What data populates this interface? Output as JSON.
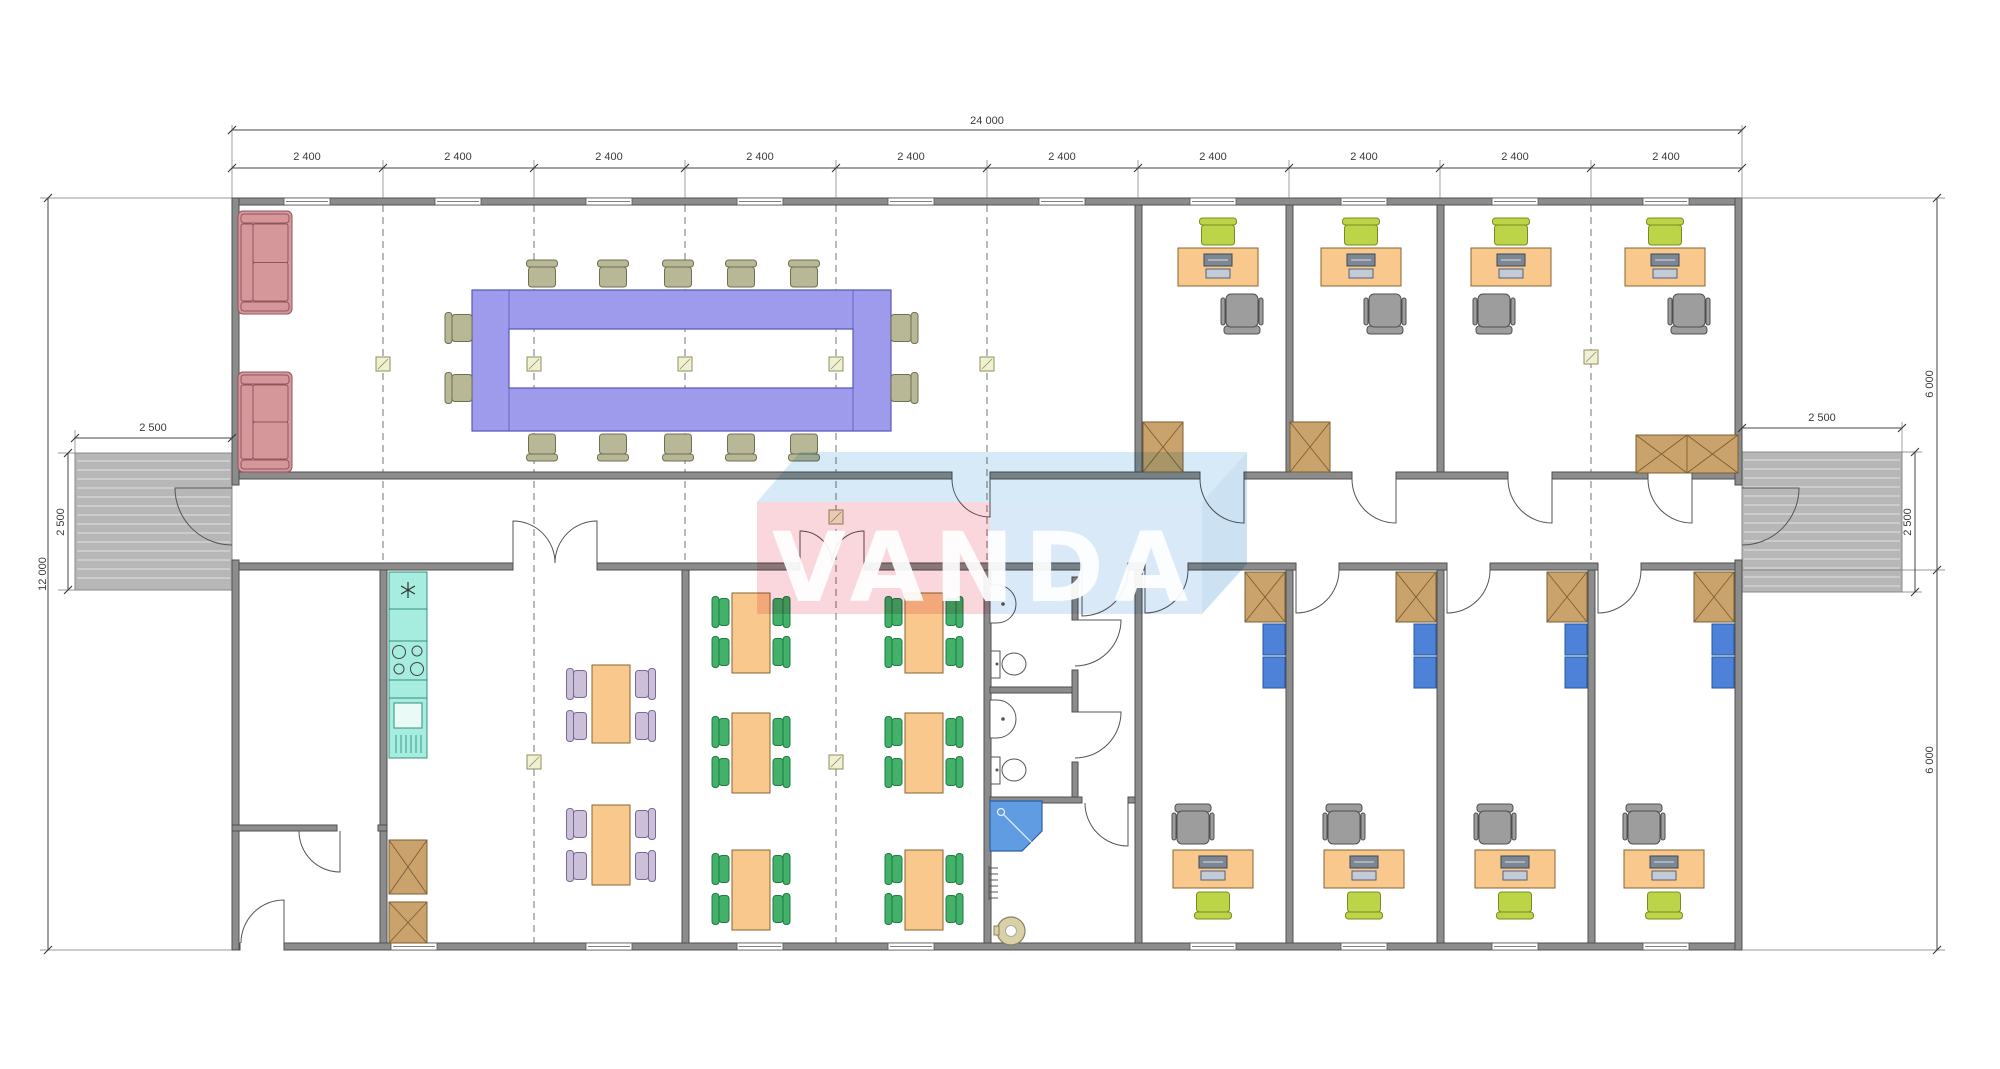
{
  "watermark": {
    "text": "VANDA"
  },
  "dims": {
    "overall": "24 000",
    "bay": "2 400",
    "height": "12 000",
    "porch": "2 500",
    "half": "6 000"
  },
  "palette": {
    "wall": "#8c8c8c",
    "wall_edge": "#4f4f4f",
    "window": "#ffffff",
    "line": "#555555",
    "sofa": "#d6979b",
    "sofa_edge": "#8f565c",
    "conf_table": "#9e9bec",
    "conf_edge": "#5b58b8",
    "chair_olive": "#b8b897",
    "chair_olive_edge": "#6f6f52",
    "desk": "#f8c88d",
    "desk_edge": "#8a6530",
    "chair_lime": "#bcd548",
    "chair_lime_edge": "#7c8a20",
    "chair_office": "#9d9d9d",
    "chair_office_edge": "#4f4f4f",
    "cabinet": "#c9a36b",
    "cabinet_edge": "#7d5f33",
    "locker": "#4d82d8",
    "locker_edge": "#27559f",
    "kitchen": "#a6ede0",
    "kitchen_edge": "#34907e",
    "chair_green": "#43b169",
    "chair_green_edge": "#1d7a43",
    "chair_lav": "#cbc0d8",
    "chair_lav_edge": "#77689a",
    "fixture": "#ffffff",
    "fixture_edge": "#555555",
    "shower": "#5f9ce2",
    "shower_edge": "#2d5fa8",
    "boiler": "#d9d0a6",
    "boiler_edge": "#8a8160",
    "ramp": "#b7b7b7",
    "ramp_edge": "#888888",
    "ramp_line": "#d9d9d9",
    "marker": "#f0f0d2",
    "marker_edge": "#8f8f5f",
    "dim": "#444444",
    "wm_top": "#badef2",
    "wm_pink": "#f7bac7",
    "wm_blue": "#c2dbf1",
    "wm_side": "#a9cde9"
  },
  "plan": {
    "walls": [
      [
        232,
        198,
        1510,
        7
      ],
      [
        232,
        472,
        720,
        7
      ],
      [
        990,
        472,
        210,
        7
      ],
      [
        1244,
        472,
        108,
        7
      ],
      [
        1396,
        472,
        112,
        7
      ],
      [
        1552,
        472,
        96,
        7
      ],
      [
        1692,
        472,
        50,
        7
      ],
      [
        232,
        563,
        281,
        7
      ],
      [
        597,
        563,
        203,
        7
      ],
      [
        864,
        563,
        218,
        7
      ],
      [
        1128,
        563,
        17,
        7
      ],
      [
        1188,
        563,
        108,
        7
      ],
      [
        1339,
        563,
        108,
        7
      ],
      [
        1490,
        563,
        108,
        7
      ],
      [
        1641,
        563,
        101,
        7
      ],
      [
        232,
        943,
        8,
        7
      ],
      [
        284,
        943,
        1458,
        7
      ],
      [
        232,
        198,
        7,
        287
      ],
      [
        232,
        560,
        7,
        390
      ],
      [
        1735,
        198,
        7,
        287
      ],
      [
        1735,
        560,
        7,
        390
      ],
      [
        1135,
        205,
        7,
        267
      ],
      [
        1286,
        205,
        7,
        267
      ],
      [
        1437,
        205,
        7,
        267
      ],
      [
        380,
        570,
        7,
        373
      ],
      [
        682,
        570,
        7,
        373
      ],
      [
        984,
        570,
        7,
        373
      ],
      [
        1135,
        570,
        7,
        373
      ],
      [
        1286,
        570,
        7,
        373
      ],
      [
        1437,
        570,
        7,
        373
      ],
      [
        1588,
        570,
        7,
        373
      ],
      [
        232,
        825,
        105,
        6
      ],
      [
        378,
        825,
        9,
        6
      ],
      [
        1072,
        577,
        6,
        43
      ],
      [
        1072,
        670,
        6,
        42
      ],
      [
        1072,
        762,
        6,
        40
      ],
      [
        990,
        687,
        82,
        6
      ],
      [
        990,
        797,
        92,
        6
      ],
      [
        1128,
        797,
        7,
        6
      ]
    ],
    "windows": [
      [
        307,
        198
      ],
      [
        458,
        198
      ],
      [
        609,
        198
      ],
      [
        760,
        198
      ],
      [
        911,
        198
      ],
      [
        1062,
        198
      ],
      [
        1213,
        198
      ],
      [
        1364,
        198
      ],
      [
        1515,
        198
      ],
      [
        1666,
        198
      ],
      [
        414,
        943
      ],
      [
        609,
        943
      ],
      [
        760,
        943
      ],
      [
        911,
        943
      ],
      [
        1213,
        943
      ],
      [
        1364,
        943
      ],
      [
        1515,
        943
      ],
      [
        1666,
        943
      ]
    ],
    "dashes": [
      [
        383,
        205,
        943
      ],
      [
        534,
        205,
        943
      ],
      [
        685,
        205,
        943
      ],
      [
        836,
        205,
        943
      ],
      [
        987,
        205,
        943
      ],
      [
        1591,
        205,
        570
      ]
    ],
    "markers": [
      [
        383,
        364
      ],
      [
        534,
        364
      ],
      [
        685,
        364
      ],
      [
        836,
        364
      ],
      [
        987,
        364
      ],
      [
        1591,
        357
      ],
      [
        836,
        517
      ],
      [
        534,
        762
      ],
      [
        836,
        762
      ]
    ],
    "sofas": [
      [
        238,
        211,
        54,
        103
      ],
      [
        238,
        372,
        54,
        100
      ]
    ],
    "conference": {
      "outer": [
        472,
        290,
        419,
        141
      ],
      "hole": [
        509,
        329,
        344,
        59
      ]
    },
    "chairs_olive": [
      [
        542,
        276,
        0
      ],
      [
        613,
        276,
        0
      ],
      [
        678,
        276,
        0
      ],
      [
        741,
        276,
        0
      ],
      [
        804,
        276,
        0
      ],
      [
        542,
        445,
        180
      ],
      [
        613,
        445,
        180
      ],
      [
        678,
        445,
        180
      ],
      [
        741,
        445,
        180
      ],
      [
        804,
        445,
        180
      ],
      [
        461,
        328,
        270
      ],
      [
        461,
        388,
        270
      ],
      [
        902,
        328,
        90
      ],
      [
        902,
        388,
        90
      ]
    ],
    "desks": [
      [
        1218,
        248
      ],
      [
        1361,
        248
      ],
      [
        1511,
        248
      ],
      [
        1665,
        248
      ],
      [
        1213,
        850
      ],
      [
        1364,
        850
      ],
      [
        1515,
        850
      ],
      [
        1664,
        850
      ]
    ],
    "chairs_lime": [
      [
        1218,
        234,
        0
      ],
      [
        1361,
        234,
        0
      ],
      [
        1511,
        234,
        0
      ],
      [
        1665,
        234,
        0
      ],
      [
        1213,
        903,
        180
      ],
      [
        1364,
        903,
        180
      ],
      [
        1515,
        903,
        180
      ],
      [
        1664,
        903,
        180
      ]
    ],
    "chairs_office": [
      [
        1242,
        311,
        180
      ],
      [
        1385,
        311,
        180
      ],
      [
        1494,
        311,
        180
      ],
      [
        1689,
        311,
        180
      ],
      [
        1193,
        827,
        0
      ],
      [
        1344,
        827,
        0
      ],
      [
        1495,
        827,
        0
      ],
      [
        1644,
        827,
        0
      ]
    ],
    "cabinets": [
      [
        1143,
        422,
        40,
        50,
        1
      ],
      [
        1290,
        422,
        40,
        50,
        1
      ],
      [
        1636,
        435,
        102,
        38,
        2
      ],
      [
        1245,
        572,
        40,
        50,
        1
      ],
      [
        1396,
        572,
        40,
        50,
        1
      ],
      [
        1547,
        572,
        40,
        50,
        1
      ],
      [
        1694,
        572,
        40,
        50,
        1
      ],
      [
        389,
        840,
        38,
        54,
        1
      ],
      [
        389,
        902,
        38,
        41,
        1
      ]
    ],
    "lockers": [
      [
        1263,
        624
      ],
      [
        1263,
        657
      ],
      [
        1414,
        624
      ],
      [
        1414,
        657
      ],
      [
        1565,
        624
      ],
      [
        1565,
        657
      ],
      [
        1712,
        624
      ],
      [
        1712,
        657
      ]
    ],
    "dining_tables": [
      [
        592,
        665,
        38,
        78
      ],
      [
        592,
        805,
        38,
        80
      ],
      [
        732,
        593,
        38,
        80
      ],
      [
        905,
        593,
        38,
        80
      ],
      [
        732,
        713,
        38,
        80
      ],
      [
        905,
        713,
        38,
        80
      ],
      [
        732,
        850,
        38,
        80
      ],
      [
        905,
        850,
        38,
        80
      ]
    ],
    "chairs_lav": [
      [
        579,
        684,
        270
      ],
      [
        579,
        726,
        270
      ],
      [
        579,
        824,
        270
      ],
      [
        579,
        866,
        270
      ],
      [
        643,
        684,
        90
      ],
      [
        643,
        726,
        90
      ],
      [
        643,
        824,
        90
      ],
      [
        643,
        866,
        90
      ]
    ],
    "chairs_green": [
      [
        723,
        612,
        270
      ],
      [
        723,
        652,
        270
      ],
      [
        779,
        612,
        90
      ],
      [
        779,
        652,
        90
      ],
      [
        896,
        612,
        270
      ],
      [
        896,
        652,
        270
      ],
      [
        952,
        612,
        90
      ],
      [
        952,
        652,
        90
      ],
      [
        723,
        732,
        270
      ],
      [
        723,
        772,
        270
      ],
      [
        779,
        732,
        90
      ],
      [
        779,
        772,
        90
      ],
      [
        896,
        732,
        270
      ],
      [
        896,
        772,
        270
      ],
      [
        952,
        732,
        90
      ],
      [
        952,
        772,
        90
      ],
      [
        723,
        869,
        270
      ],
      [
        723,
        909,
        270
      ],
      [
        779,
        869,
        90
      ],
      [
        779,
        909,
        90
      ],
      [
        896,
        869,
        270
      ],
      [
        896,
        909,
        270
      ],
      [
        952,
        869,
        90
      ],
      [
        952,
        909,
        90
      ]
    ],
    "doors": [
      "M990,479 L990,517 A38 38 0 0 1 952,479",
      "M1244,479 L1244,523 A44 44 0 0 1 1200,479",
      "M1396,479 L1396,523 A44 44 0 0 1 1352,479",
      "M1552,479 L1552,523 A44 44 0 0 1 1508,479",
      "M1692,479 L1692,523 A44 44 0 0 1 1648,479",
      "M513,563 L513,521 A42 42 0 0 1 555,563",
      "M597,563 L597,521 A42 42 0 0 0 555,563",
      "M800,563 L800,531 A32 32 0 0 1 832,563",
      "M864,563 L864,531 A32 32 0 0 0 832,563",
      "M1082,570 L1082,616 A46 46 0 0 0 1128,570",
      "M1145,570 L1145,613 A43 43 0 0 0 1188,570",
      "M1296,570 L1296,613 A43 43 0 0 0 1339,570",
      "M1447,570 L1447,613 A43 43 0 0 0 1490,570",
      "M1598,570 L1598,613 A43 43 0 0 0 1641,570",
      "M1075,620 L1121,620 A46 46 0 0 1 1075,666",
      "M1075,712 L1121,712 A46 46 0 0 1 1075,758",
      "M1128,803 L1128,846 A43 43 0 0 1 1085,803",
      "M340,831 L340,872 A41 41 0 0 1 299,831",
      "M284,943 L284,900 A43 43 0 0 0 241,943",
      "M232,488 L175,488 A57 57 0 0 0 232,545",
      "M1742,488 L1799,488 A57 57 0 0 1 1742,545"
    ],
    "ramps": [
      [
        75,
        453,
        157,
        137
      ],
      [
        1742,
        452,
        160,
        140
      ]
    ],
    "ext": [
      [
        232,
        198,
        232,
        125
      ],
      [
        1742,
        198,
        1742,
        125
      ],
      [
        383,
        198,
        383,
        160
      ],
      [
        534,
        198,
        534,
        160
      ],
      [
        685,
        198,
        685,
        160
      ],
      [
        836,
        198,
        836,
        160
      ],
      [
        987,
        198,
        987,
        160
      ],
      [
        1138,
        198,
        1138,
        160
      ],
      [
        1289,
        198,
        1289,
        160
      ],
      [
        1440,
        198,
        1440,
        160
      ],
      [
        1591,
        198,
        1591,
        160
      ],
      [
        232,
        198,
        40,
        198
      ],
      [
        232,
        950,
        40,
        950
      ],
      [
        75,
        453,
        75,
        430
      ],
      [
        75,
        453,
        58,
        453
      ],
      [
        75,
        590,
        58,
        590
      ],
      [
        1902,
        452,
        1902,
        422
      ],
      [
        1902,
        452,
        1922,
        452
      ],
      [
        1902,
        592,
        1922,
        592
      ],
      [
        1742,
        198,
        1945,
        198
      ],
      [
        1742,
        570,
        1945,
        570
      ],
      [
        1742,
        950,
        1945,
        950
      ]
    ],
    "ticks": [
      [
        232,
        130
      ],
      [
        1742,
        130
      ],
      [
        232,
        168
      ],
      [
        383,
        168
      ],
      [
        534,
        168
      ],
      [
        685,
        168
      ],
      [
        836,
        168
      ],
      [
        987,
        168
      ],
      [
        1138,
        168
      ],
      [
        1289,
        168
      ],
      [
        1440,
        168
      ],
      [
        1591,
        168
      ],
      [
        1742,
        168
      ],
      [
        75,
        438
      ],
      [
        232,
        438
      ],
      [
        1742,
        428
      ],
      [
        1902,
        428
      ],
      [
        48,
        198
      ],
      [
        48,
        950
      ],
      [
        68,
        453
      ],
      [
        68,
        590
      ],
      [
        1915,
        452
      ],
      [
        1915,
        592
      ],
      [
        1937,
        198
      ],
      [
        1937,
        570
      ],
      [
        1937,
        950
      ]
    ]
  }
}
